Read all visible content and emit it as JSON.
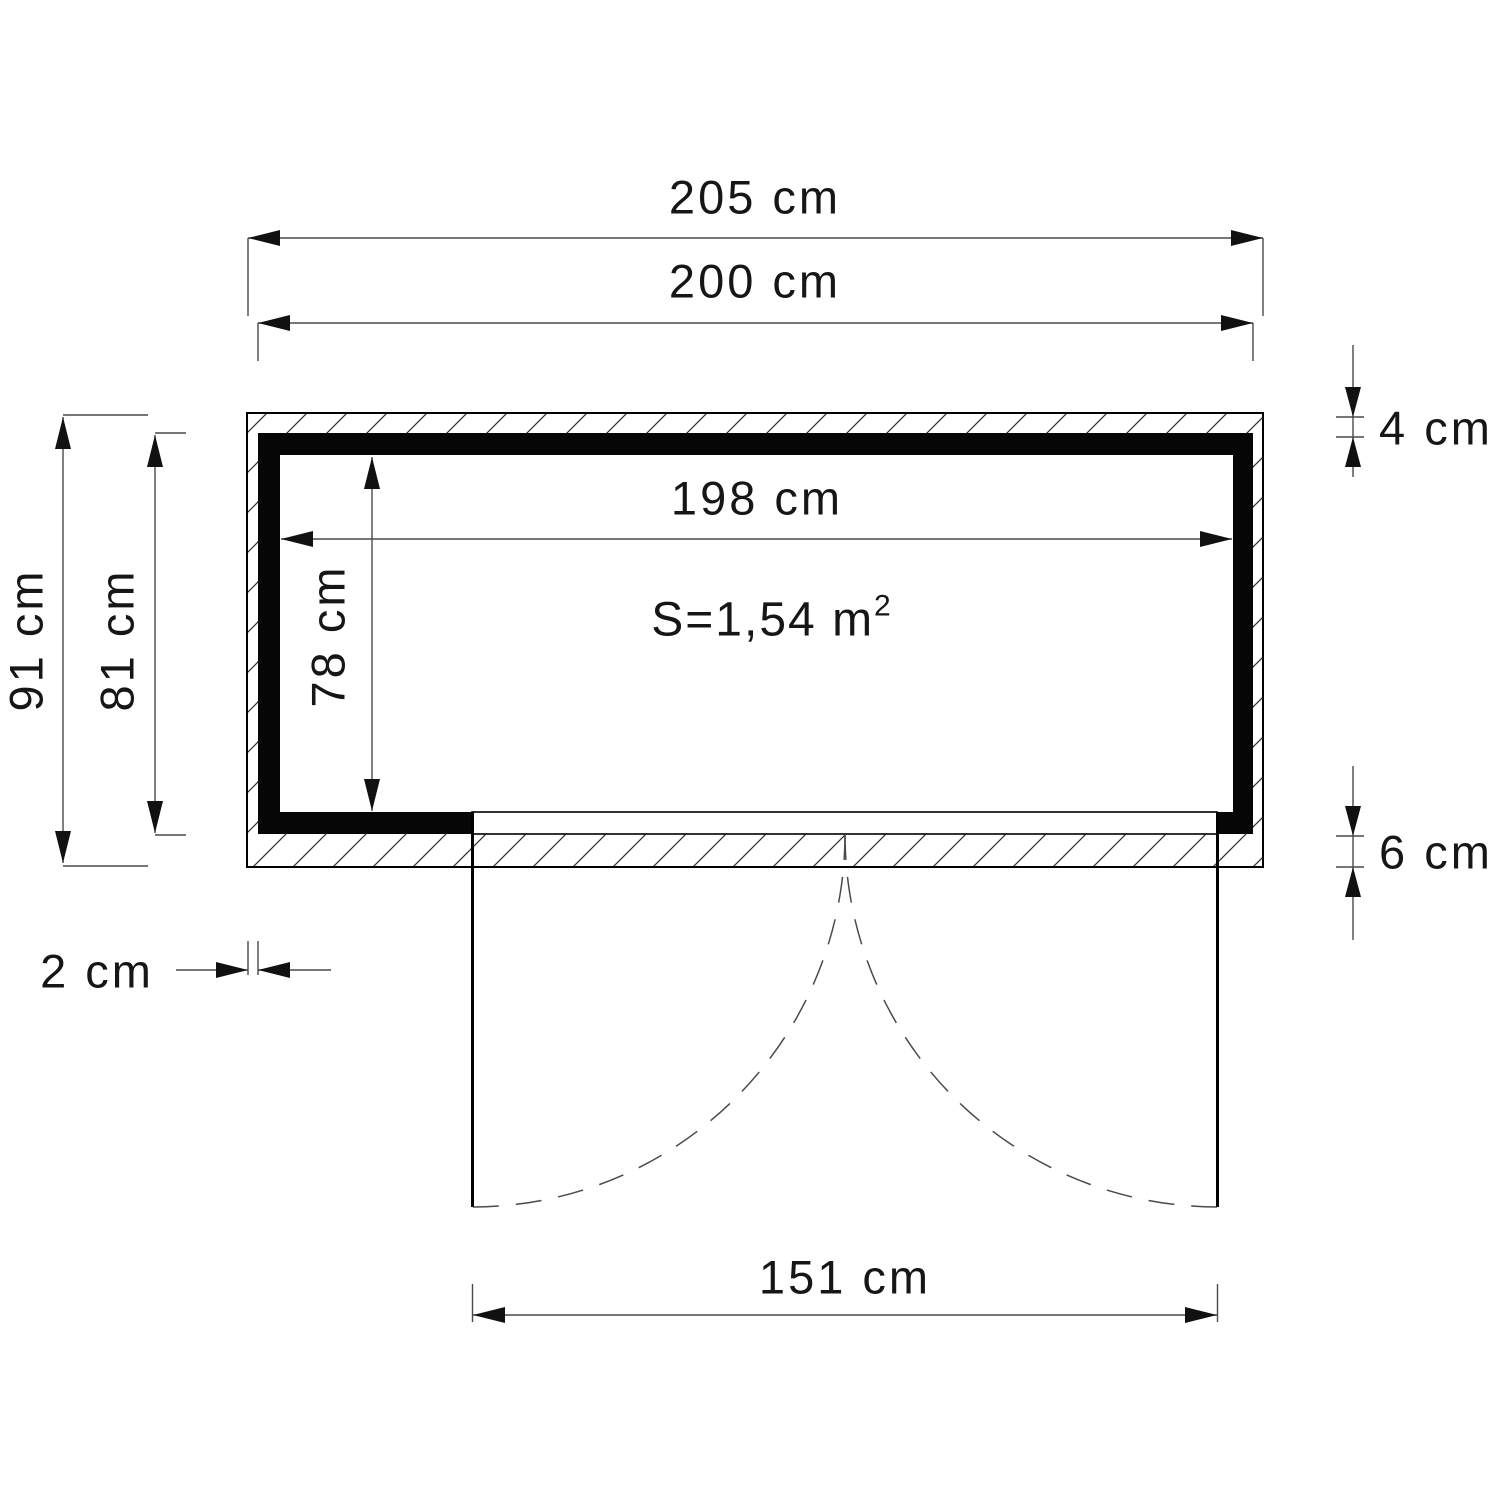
{
  "plan": {
    "type": "shed-floor-plan-top-view",
    "unit": "cm",
    "dims": {
      "outer_width": "205 cm",
      "cladding_width": "200 cm",
      "inner_width": "198 cm",
      "outer_depth": "91 cm",
      "cladding_depth": "81 cm",
      "inner_depth": "78 cm",
      "top_wall_thickness": "4 cm",
      "bottom_wall_thickness": "6 cm",
      "side_cladding_thickness": "2 cm",
      "door_opening_width": "151 cm"
    },
    "values_cm": {
      "outer_width": 205,
      "cladding_width": 200,
      "inner_width": 198,
      "outer_depth": 91,
      "cladding_depth": 81,
      "inner_depth": 78,
      "top_wall_thickness": 4,
      "bottom_wall_thickness": 6,
      "side_cladding_thickness": 2,
      "door_opening_width": 151
    },
    "area": {
      "prefix": "S=1,54 m",
      "sup": "2"
    },
    "colors": {
      "line": "#000000",
      "dim_line": "#4a4a4a",
      "text": "#161616",
      "background": "#ffffff"
    }
  }
}
